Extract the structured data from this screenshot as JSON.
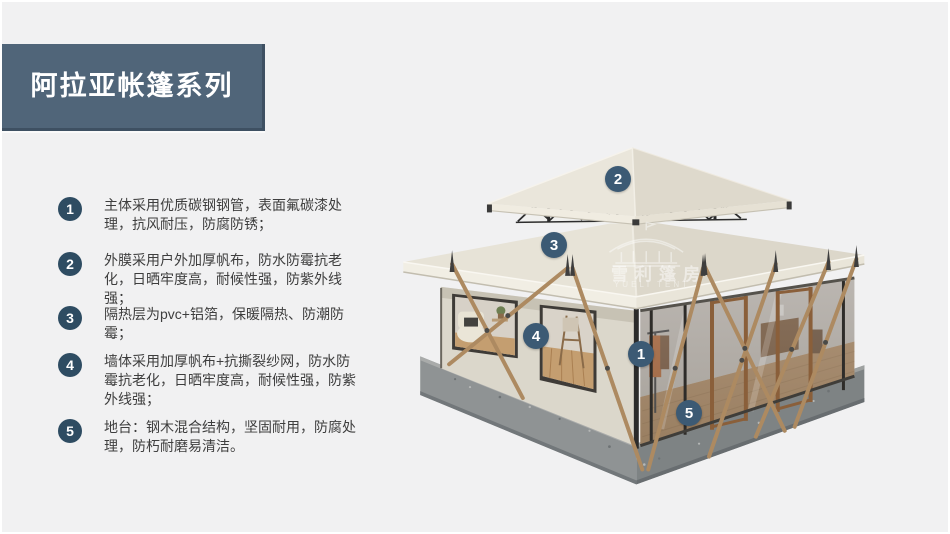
{
  "page": {
    "background": "#f1f1f2",
    "frame": "#ffffff"
  },
  "banner": {
    "title": "阿拉亚帐篷系列",
    "bg": "#506579",
    "edge": "#3e5062"
  },
  "features": {
    "badge_color": "#2e4c62",
    "items": [
      {
        "num": "1",
        "text": "主体采用优质碳钢钢管，表面氟碳漆处理，抗风耐压，防腐防锈；"
      },
      {
        "num": "2",
        "text": "外膜采用户外加厚帆布，防水防霉抗老化，日晒牢度高，耐候性强，防紫外线强；"
      },
      {
        "num": "3",
        "text": "隔热层为pvc+铝箔，保暖隔热、防潮防霉；"
      },
      {
        "num": "4",
        "text": "墙体采用加厚帆布+抗撕裂纱网，防水防霉抗老化，日晒牢度高，耐候性强，防紫外线强；"
      },
      {
        "num": "5",
        "text": "地台：钢木混合结构，坚固耐用，防腐处理，防朽耐磨易清洁。"
      }
    ]
  },
  "callouts": {
    "badge_color": "#3c5a74",
    "items": [
      {
        "label": "1"
      },
      {
        "label": "2"
      },
      {
        "label": "3"
      },
      {
        "label": "4"
      },
      {
        "label": "5"
      }
    ]
  },
  "watermark": {
    "cn": "雪利篷房",
    "en": "YUELI TENT"
  }
}
